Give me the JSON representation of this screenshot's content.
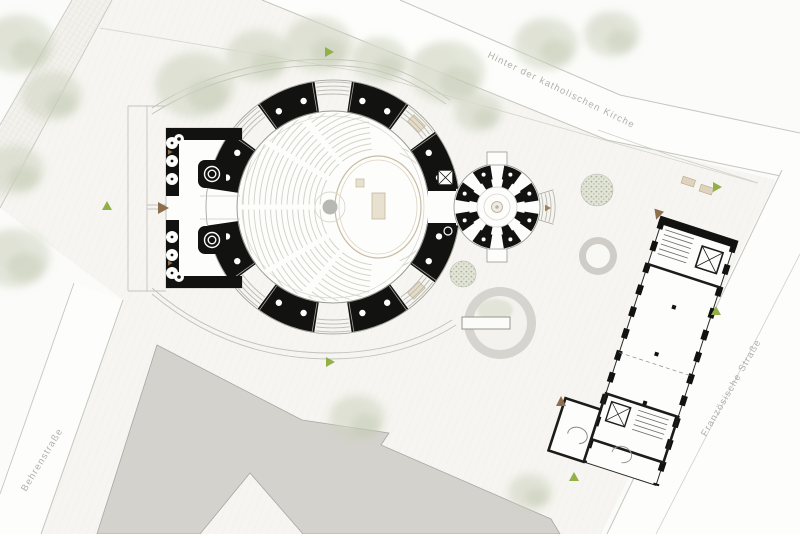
{
  "title": "Kirche Lageplan",
  "streets": {
    "top": {
      "label": "Hinter der katholischen Kirche"
    },
    "right": {
      "label": "Französische Straße"
    },
    "left": {
      "label": "Behrenstraße"
    }
  },
  "icons": {
    "entrance_arrow": "brown-triangle",
    "site_marker": "green-triangle",
    "tree_canopy": "soft-green-blob",
    "planter": "gray-ring-circle"
  },
  "colors": {
    "poche": "#121210",
    "background": "#fbfbf9",
    "site": "#f6f5f1",
    "street_line": "#c6c6bf",
    "neighbor_building": "#d4d2cd",
    "accent_tan": "#d9ccb0",
    "marker_green": "#93af49",
    "marker_brown": "#8d6e4f",
    "tree": "#ccd1bd",
    "label_text": "#b0b0a9",
    "pew_line": "#d4d4cb",
    "font_dot": "#b7b7b3"
  }
}
